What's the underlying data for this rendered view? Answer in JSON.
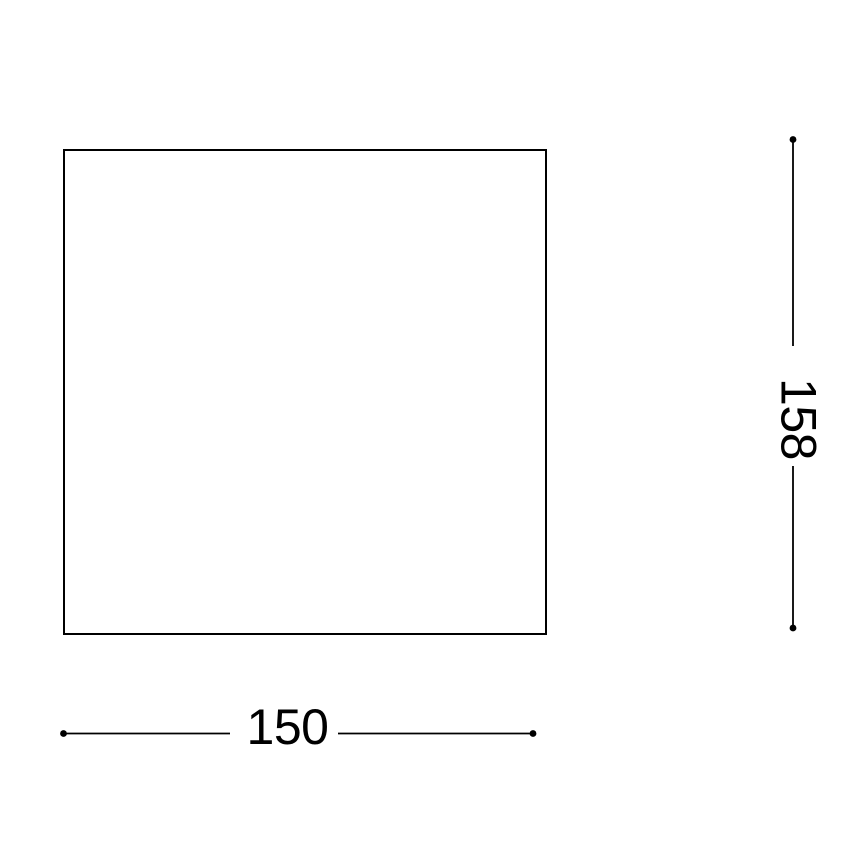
{
  "diagram": {
    "type": "technical-dimension-drawing",
    "width_label": "150",
    "height_label": "158",
    "line_color": "#000000",
    "background_color": "#ffffff"
  }
}
